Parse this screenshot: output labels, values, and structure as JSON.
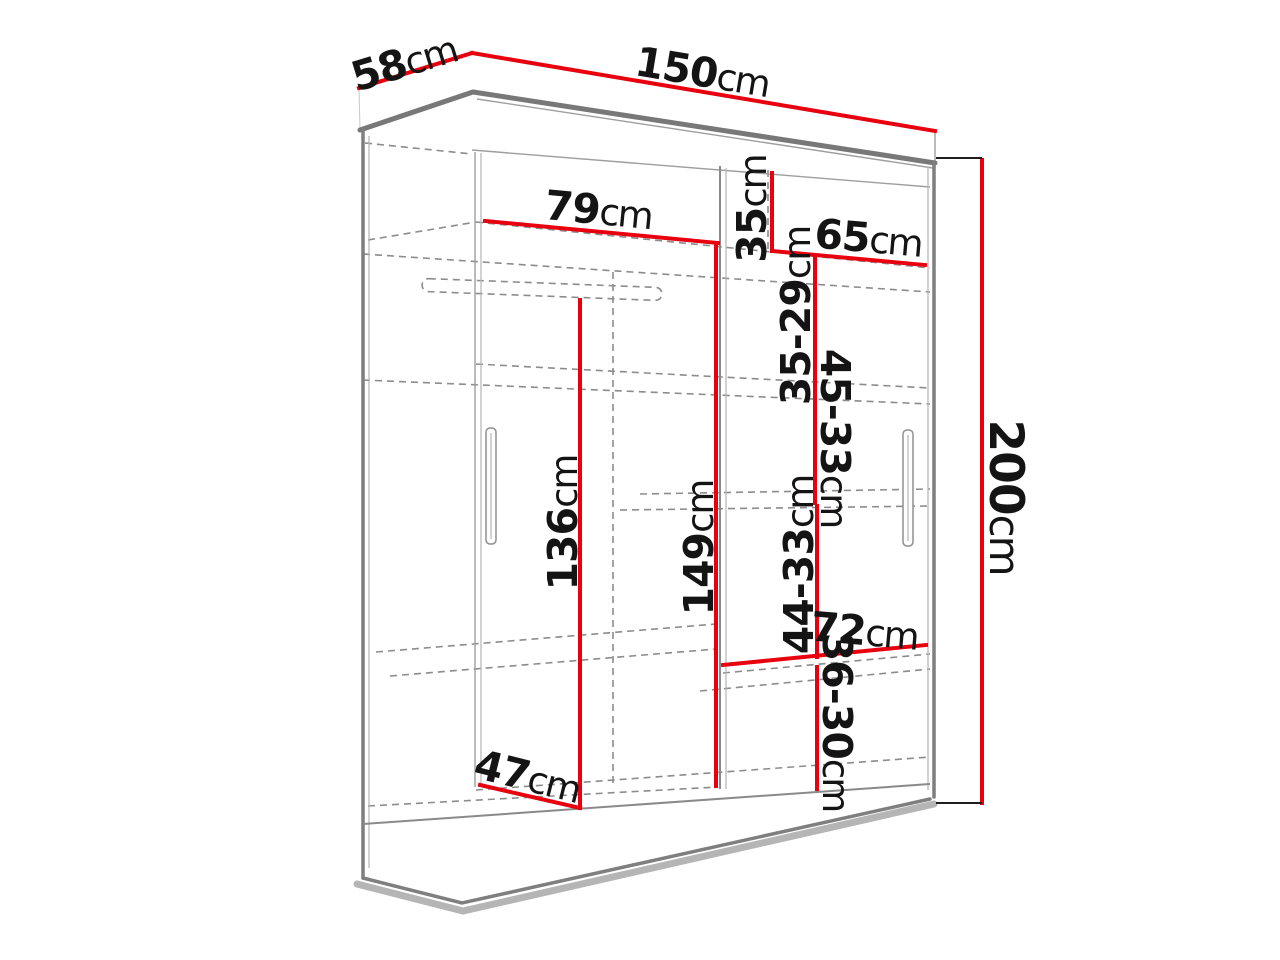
{
  "diagram": {
    "type": "wardrobe-dimensions",
    "unit_suffix": "cm",
    "colors": {
      "dimension_line": "#e8000f",
      "outline": "#7f7f7f",
      "hidden_line": "#8c8c8c",
      "label_text": "#141414",
      "background": "#ffffff"
    },
    "dims": {
      "total_width": {
        "num": "150",
        "unit": "cm"
      },
      "total_depth": {
        "num": "58",
        "unit": "cm"
      },
      "left_shelf_w": {
        "num": "79",
        "unit": "cm"
      },
      "top_gap": {
        "num": "35",
        "unit": "cm"
      },
      "right_shelf_w": {
        "num": "65",
        "unit": "cm"
      },
      "gap_1": {
        "num": "35-29",
        "unit": "cm"
      },
      "gap_2": {
        "num": "45-33",
        "unit": "cm"
      },
      "hanging_h": {
        "num": "136",
        "unit": "cm"
      },
      "interior_h": {
        "num": "149",
        "unit": "cm"
      },
      "total_height": {
        "num": "200",
        "unit": "cm"
      },
      "gap_3": {
        "num": "44-33",
        "unit": "cm"
      },
      "bottom_shelf_w": {
        "num": "72",
        "unit": "cm"
      },
      "gap_4": {
        "num": "36-30",
        "unit": "cm"
      },
      "floor_depth": {
        "num": "47",
        "unit": "cm"
      }
    }
  }
}
